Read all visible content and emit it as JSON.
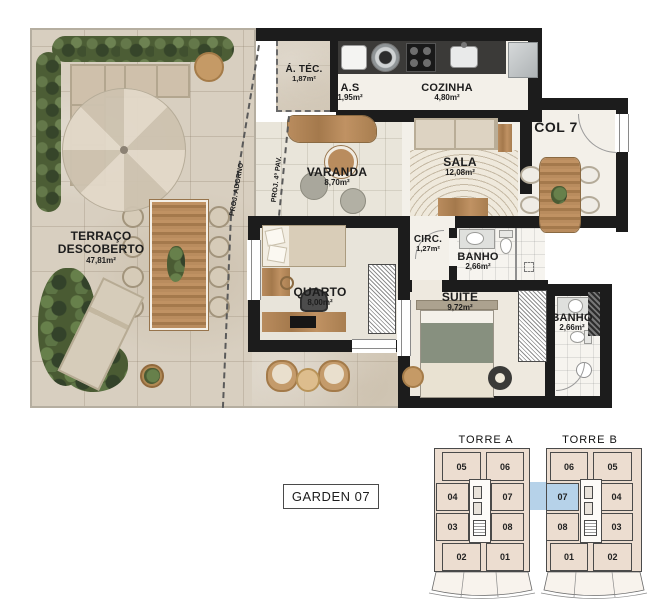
{
  "plan": {
    "rooms": {
      "terraco": {
        "name": "TERRAÇO DESCOBERTO",
        "area": "47,81m²"
      },
      "atec": {
        "name": "Á. TÉC.",
        "area": "1,87m²"
      },
      "as": {
        "name": "A.S",
        "area": "1,95m²"
      },
      "cozinha": {
        "name": "COZINHA",
        "area": "4,80m²"
      },
      "col7": {
        "name": "COL 7"
      },
      "varanda": {
        "name": "VARANDA",
        "area": "8,70m²"
      },
      "sala": {
        "name": "SALA",
        "area": "12,08m²"
      },
      "quarto": {
        "name": "QUARTO",
        "area": "8,00m²"
      },
      "circ": {
        "name": "CIRC.",
        "area": "1,27m²"
      },
      "banho1": {
        "name": "BANHO",
        "area": "2,66m²"
      },
      "suite": {
        "name": "SUÍTE",
        "area": "9,72m²"
      },
      "banho2": {
        "name": "BANHO",
        "area": "2,66m²"
      }
    },
    "annotations": {
      "adorno": "PROJ. ADORNO",
      "pav4": "PROJ. 4º PAV."
    }
  },
  "unit_label": "GARDEN 07",
  "keyplan": {
    "tower_a": {
      "label": "TORRE A",
      "units": [
        "05",
        "06",
        "04",
        "07",
        "03",
        "08",
        "02",
        "01"
      ]
    },
    "tower_b": {
      "label": "TORRE B",
      "units": [
        "06",
        "05",
        "07",
        "04",
        "08",
        "03",
        "01",
        "02"
      ]
    },
    "highlighted_unit": "07"
  },
  "colors": {
    "wall": "#1c1c1c",
    "terrace": "#d8cfc0",
    "keyplan_fill": "#ecddd0",
    "highlight": "#b6d2e9"
  }
}
